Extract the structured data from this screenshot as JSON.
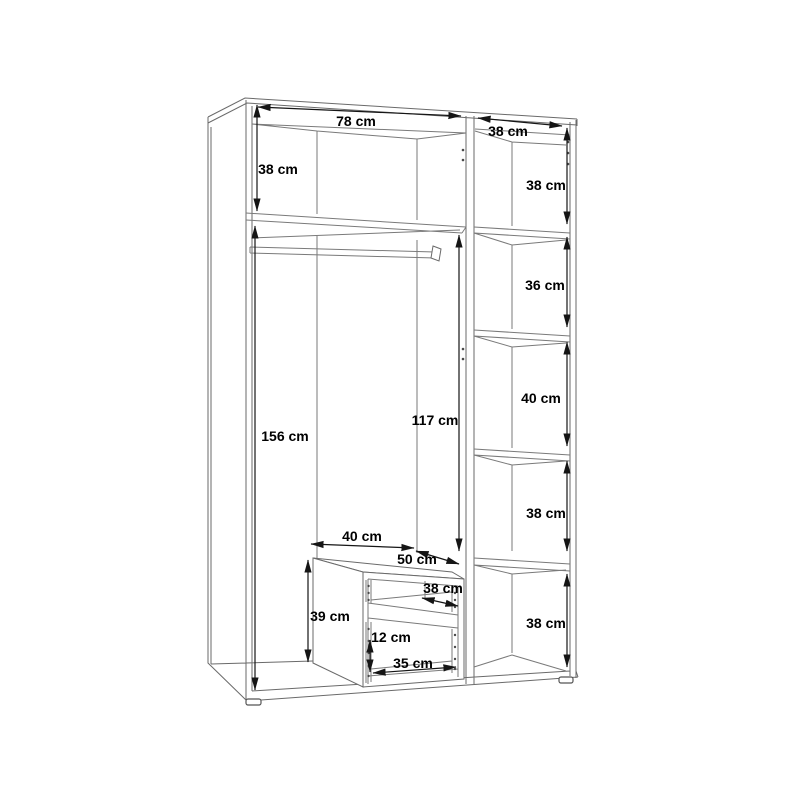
{
  "diagram": {
    "subject": "wardrobe-interior-dimension-drawing",
    "unit": "cm",
    "colors": {
      "background": "#ffffff",
      "structure_line": "#6a6a6a",
      "dimension_line": "#151515",
      "label_text": "#000000"
    },
    "dims": {
      "left_section_width": "78 cm",
      "right_section_width": "38 cm",
      "left_top_shelf_height": "38 cm",
      "left_hanging_space_height": "156 cm",
      "middle_clear_height": "117 cm",
      "right_shelf_1_height": "38 cm",
      "right_shelf_2_height": "36 cm",
      "right_shelf_3_height": "40 cm",
      "right_shelf_4_height": "38 cm",
      "right_shelf_5_height": "38 cm",
      "drawer_unit_width": "40 cm",
      "drawer_unit_depth": "50 cm",
      "drawer_unit_height": "39 cm",
      "drawer_opening_width": "38 cm",
      "drawer_opening_height": "12 cm",
      "drawer_bottom_width": "35 cm"
    }
  }
}
